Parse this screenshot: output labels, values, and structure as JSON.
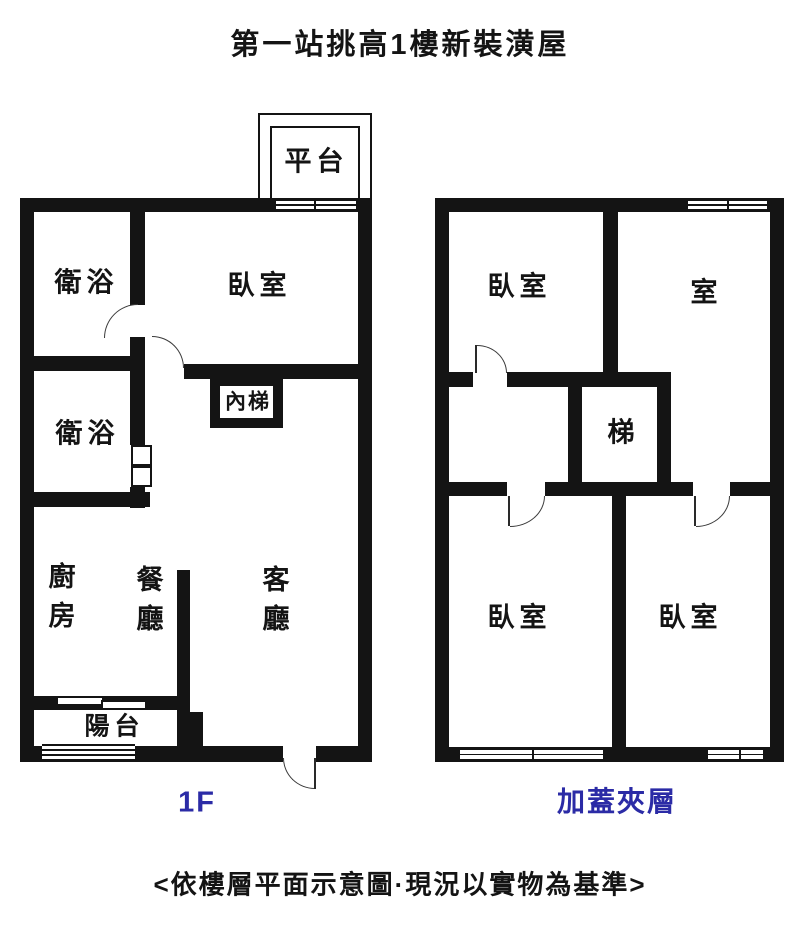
{
  "title": "第一站挑高1樓新裝潢屋",
  "caption": "<依樓層平面示意圖·現況以實物為基準>",
  "colors": {
    "wall": "#141414",
    "text": "#141414",
    "floor_label_blue": "#2b2ba6"
  },
  "floor_1f": {
    "label": "1F",
    "rooms": {
      "platform": "平台",
      "bath_top": "衛浴",
      "bedroom": "臥室",
      "bath_mid": "衛浴",
      "inner_stairs": "內梯",
      "kitchen": "廚房",
      "dining": "餐廳",
      "living": "客廳",
      "balcony": "陽台"
    }
  },
  "floor_mezzanine": {
    "label": "加蓋夾層",
    "rooms": {
      "bedroom_top_left": "臥室",
      "room_top_right": "室",
      "stairs": "梯",
      "bedroom_bottom_left": "臥室",
      "bedroom_bottom_right": "臥室"
    }
  }
}
